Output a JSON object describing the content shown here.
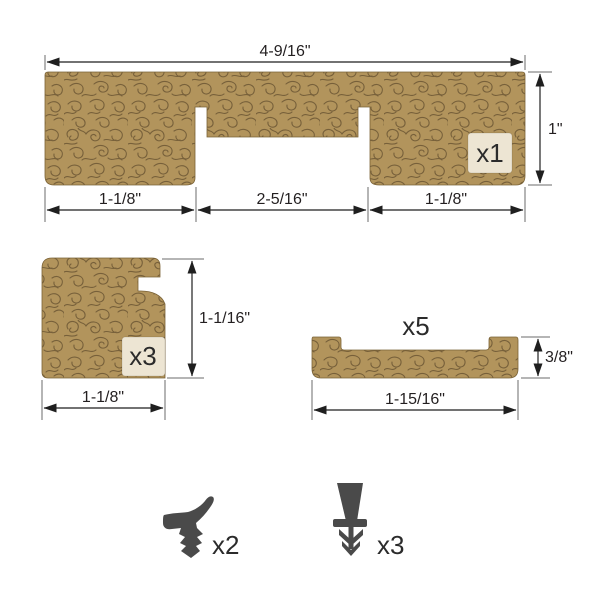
{
  "diagram": {
    "head_profile": {
      "count": "x1",
      "width": "4-9/16\"",
      "height": "1\"",
      "bottom_left": "1-1/8\"",
      "bottom_center": "2-5/16\"",
      "bottom_right": "1-1/8\""
    },
    "corner_profile": {
      "count": "x3",
      "height": "1-1/16\"",
      "width": "1-1/8\""
    },
    "flat_profile": {
      "count": "x5",
      "height": "3/8\"",
      "width": "1-15/16\""
    },
    "hook_seal": {
      "count": "x2",
      "icon": "kerf-hook-seal-icon"
    },
    "barbed_seal": {
      "count": "x3",
      "icon": "barbed-wedge-seal-icon"
    }
  },
  "colors": {
    "background": "#ffffff",
    "wood_fill": "#b2945c",
    "wood_grain": "#77603a",
    "label_box": "#ede5d3",
    "seal": "#4a4a4a",
    "dimension_line": "#1f1f1f",
    "extension_line": "#6b6b6b",
    "text": "#231f20"
  }
}
